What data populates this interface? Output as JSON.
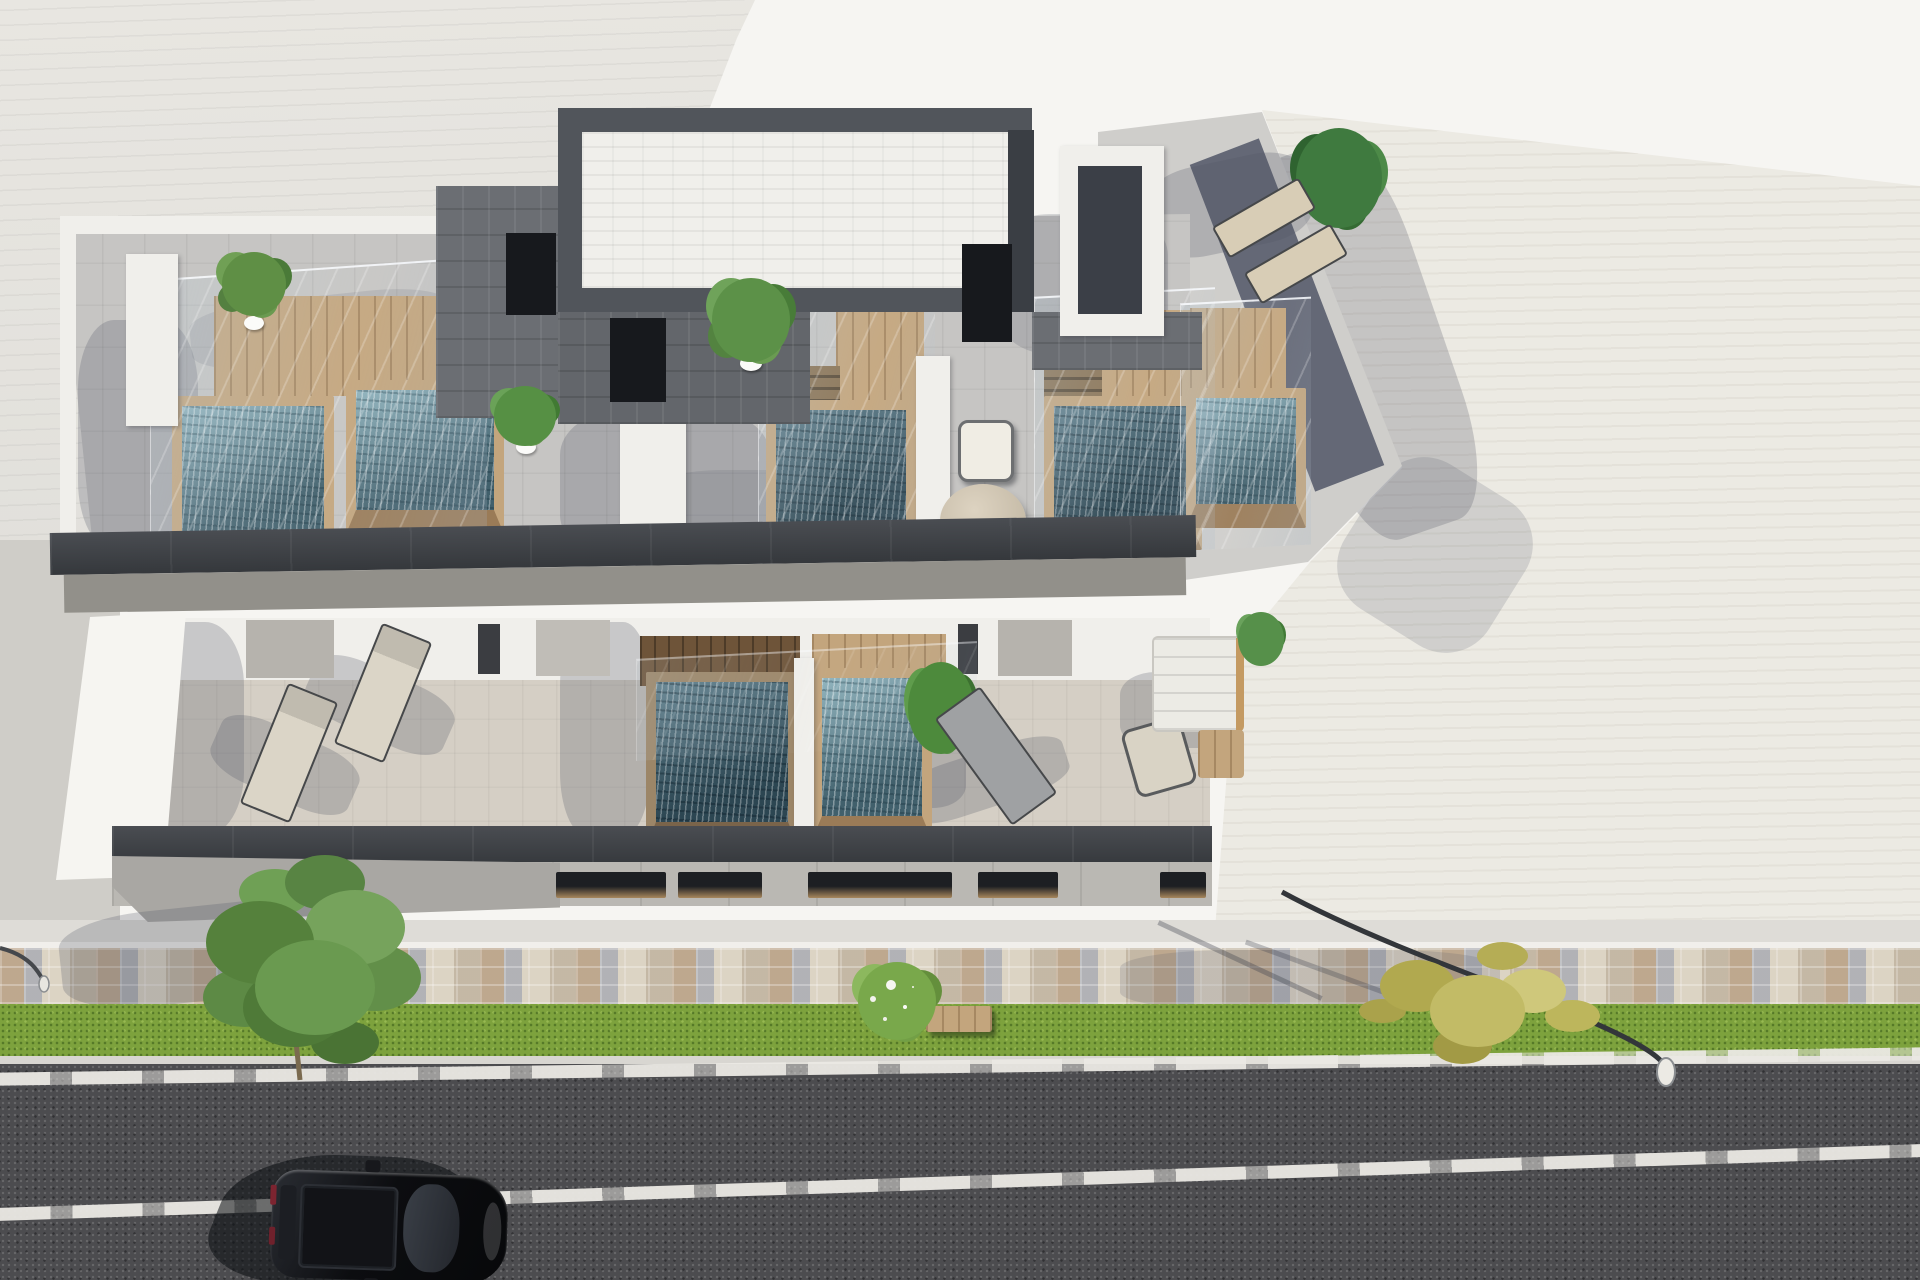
{
  "scene": {
    "type": "architectural-3d-render",
    "view": "aerial-oblique-top-down",
    "description": "Daylight aerial rendering of a modern white residential block with rooftop plunge pools, wood decks and glass railings on two terrace levels, fronted by a mosaic paver promenade, grass verge and asphalt street with one parked black car.",
    "lighting": "hard midday sun casting long shadows to the lower-left"
  },
  "palette": {
    "sky": "#f6f5f2",
    "roof-left": "#e3e1dc",
    "roof-right": "#eceae3",
    "roof-terrace": "#c6c5c3",
    "terrace-lower": "#d5cfc5",
    "fascia-dark": "#3f4347",
    "soffit-gray": "#92908a",
    "wall-white": "#f0efeb",
    "wall-gray": "#b6b3ad",
    "wood-light": "#c3a57d",
    "wood-dark": "#6e5439",
    "water-light": "#7fa6b2",
    "water-dark": "#3c5a66",
    "facade-gray": "#bab8b3",
    "window-wood": "#a8875c",
    "walkway": "#dedcd7",
    "mosaic-base": "#cfc8bb",
    "grass": "#7da23d",
    "curb": "#d8d6d1",
    "road": "#4c4c4f",
    "lane-marking": "#e8e6e1",
    "car-body": "#101114",
    "tree-green": "#5f8f45",
    "tree-autumn": "#c0b95f"
  },
  "building": {
    "label": "modern residential block with rooftop pool terraces",
    "upper_roof": {
      "plunge_pools": 5,
      "wood_decks": 5,
      "glass_railings": true,
      "white_brick_volume": 1,
      "dark_stair_roofs": 3,
      "stairwell_openings": 3,
      "potted_plants": 3,
      "palm_plants": 1,
      "sun_loungers": 2,
      "round_table": 1,
      "chairs": 1
    },
    "lower_terrace": {
      "plunge_pools": 2,
      "sun_loungers": 2,
      "chaise_lounge": 1,
      "armchair": 1,
      "sofa": 1,
      "wood_coffee_table": 1,
      "plants": 2
    },
    "front": {
      "window_slits": 5,
      "paver_promenade": true
    }
  },
  "street_scene": {
    "grass_verge": true,
    "bench": 1,
    "flowering_shrub": 1,
    "green_tree": 1,
    "autumn_tree": 1,
    "street_lamps": 2,
    "lane_markings": 2,
    "parked_cars": 1,
    "car_color": "black"
  },
  "neighbors": {
    "left_roof": "light gray seamed roof",
    "right_roof": "cream tiled roof"
  }
}
